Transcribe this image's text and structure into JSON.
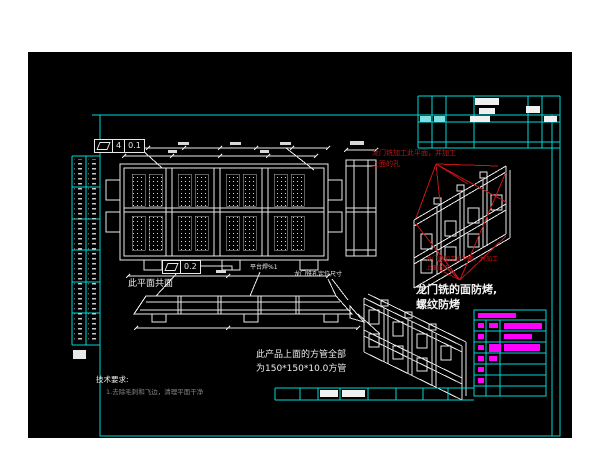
{
  "drawing": {
    "gdt_frames": [
      {
        "name": "flatness-top",
        "cells": [
          "4",
          "0.1"
        ]
      },
      {
        "name": "flatness-bottom",
        "cells": [
          "0.2"
        ]
      }
    ],
    "labels": {
      "coplanar": "此平面共面",
      "platform_weld": "平台焊%1",
      "gantry_hole_dim": "龙门铣孔定位尺寸"
    },
    "annotations": {
      "red_top_line1": "龙门铣加工此平面，并加工",
      "red_top_line2": "上面的孔",
      "red_mid_line1": "龙门铣加工此平面，并加工",
      "red_mid_line2": "上面的孔",
      "white_note_line1": "龙门铣的面防烤,",
      "white_note_line2": "螺纹防烤",
      "tube_note_line1": "此产品上面的方管全部",
      "tube_note_line2": "为150*150*10.0方管",
      "tech_title": "技术要求:",
      "tech_item1": "1.去除毛刺和飞边，清理平面干净"
    },
    "colors": {
      "frame_cyan": "#00d8d8",
      "line_white": "#e8e8e8",
      "annotation_red": "#c41414",
      "table_magenta": "#ff00ff",
      "canvas_black": "#000000"
    }
  }
}
